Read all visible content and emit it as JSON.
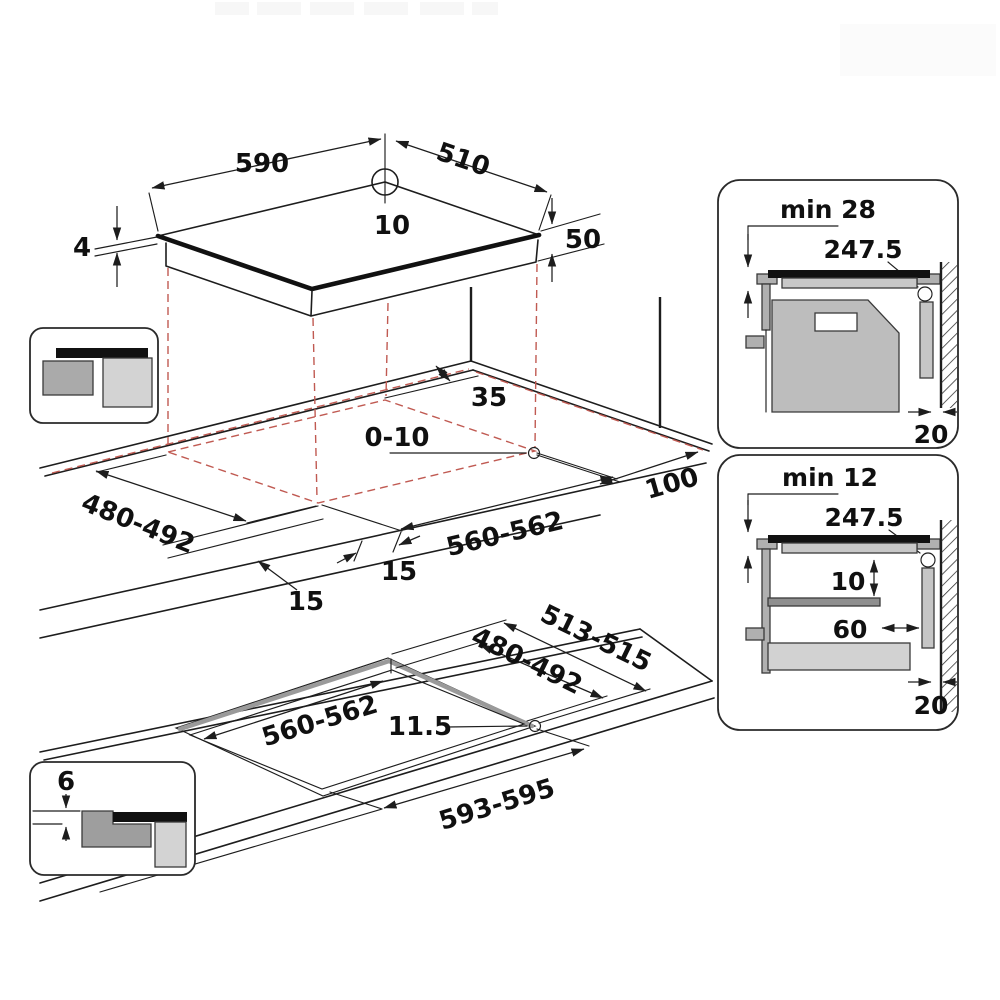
{
  "top_view": {
    "width": "590",
    "depth": "510",
    "center_offset": "10",
    "glass_thickness": "4",
    "body_height": "50"
  },
  "surface_mount": {
    "wall_clearance": "35",
    "hob_to_wall": "0-10",
    "side_clearance": "100",
    "cutout_depth": "480-492",
    "cutout_width": "560-562",
    "front_overhang": "15",
    "side_overhang": "15"
  },
  "flush_mount": {
    "rebate_depth": "513-515",
    "cutout_depth": "480-492",
    "cutout_width": "560-562",
    "corner_radius": "11.5",
    "rebate_width": "593-595",
    "rebate_step_depth": "6"
  },
  "clearance_oven": {
    "min_gap": "min 28",
    "center_width": "247.5",
    "rear_gap": "20"
  },
  "clearance_drawer": {
    "min_gap": "min 12",
    "center_width": "247.5",
    "shelf_gap": "10",
    "shelf_setback": "60",
    "rear_gap": "20"
  }
}
